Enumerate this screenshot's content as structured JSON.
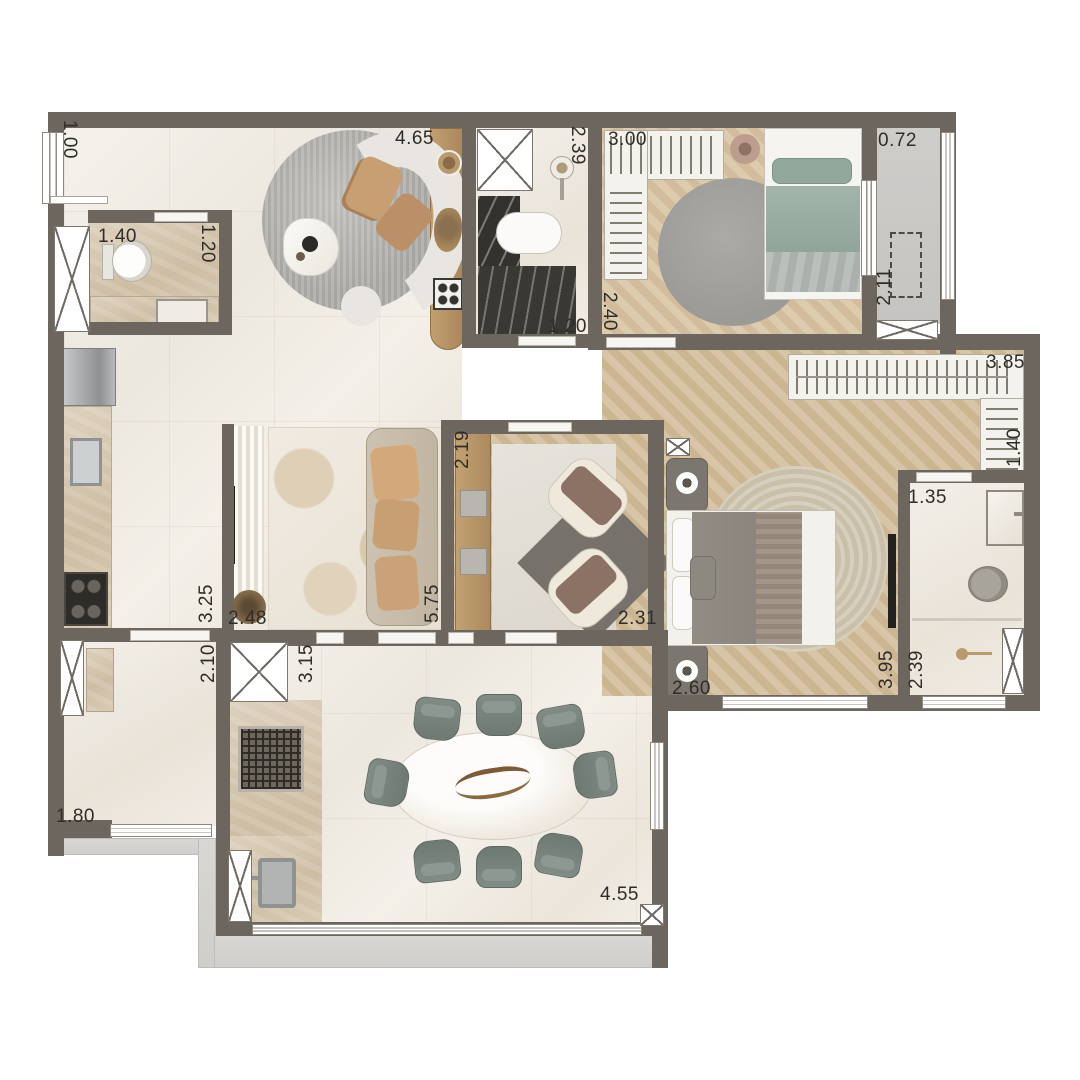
{
  "plan": {
    "type": "apartment-floor-plan-top-view",
    "dimension_labels": [
      {
        "text": "1.00"
      },
      {
        "text": "1.40"
      },
      {
        "text": "1.20"
      },
      {
        "text": "4.65"
      },
      {
        "text": "2.39"
      },
      {
        "text": "3.00"
      },
      {
        "text": "0.72"
      },
      {
        "text": "2.11"
      },
      {
        "text": "2.40"
      },
      {
        "text": "1.20"
      },
      {
        "text": "3.85"
      },
      {
        "text": "1.40"
      },
      {
        "text": "1.35"
      },
      {
        "text": "2.19"
      },
      {
        "text": "3.25"
      },
      {
        "text": "2.48"
      },
      {
        "text": "5.75"
      },
      {
        "text": "2.31"
      },
      {
        "text": "2.10"
      },
      {
        "text": "3.15"
      },
      {
        "text": "2.60"
      },
      {
        "text": "3.95"
      },
      {
        "text": "2.39"
      },
      {
        "text": "1.80"
      },
      {
        "text": "4.55"
      }
    ],
    "colors": {
      "wall": "#6c665f",
      "marble_floor": "#f1ede6",
      "herringbone_wood": "#d3c0a1",
      "travertine": "#d6c9b3",
      "terrace_concrete": "#d5d4d1",
      "sage_bedding": "#9fb2a7",
      "tan_upholstery": "#c89e73",
      "dining_chair": "#7b857f",
      "dark_stone_counter": "#34322e"
    }
  }
}
